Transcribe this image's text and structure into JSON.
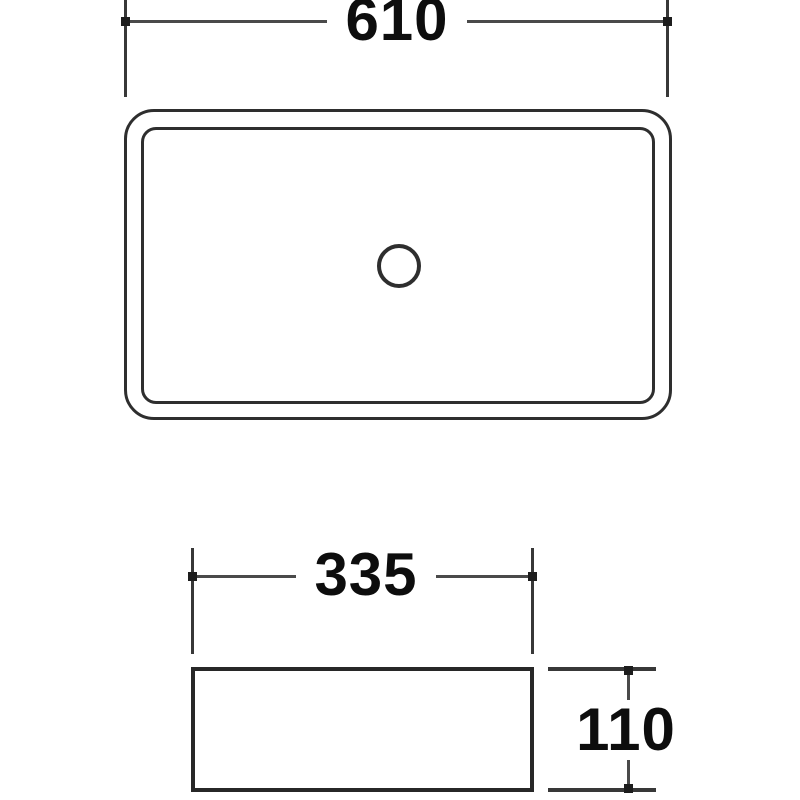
{
  "drawing": {
    "title": "basin dimension drawing",
    "colors": {
      "background": "#ffffff",
      "object_line": "#2e2e2e",
      "dimension_line": "#4a4a4a",
      "extension_line": "#383838",
      "text": "#0d0d0d"
    },
    "views": {
      "top_view": {
        "shape": "rounded rectangle with inner rim and central drain hole circle"
      },
      "front_view": {
        "shape": "plain rectangle"
      }
    },
    "dimensions": {
      "top_width": {
        "label": "610"
      },
      "base_width": {
        "label": "335"
      },
      "base_height": {
        "label": "110"
      }
    }
  }
}
